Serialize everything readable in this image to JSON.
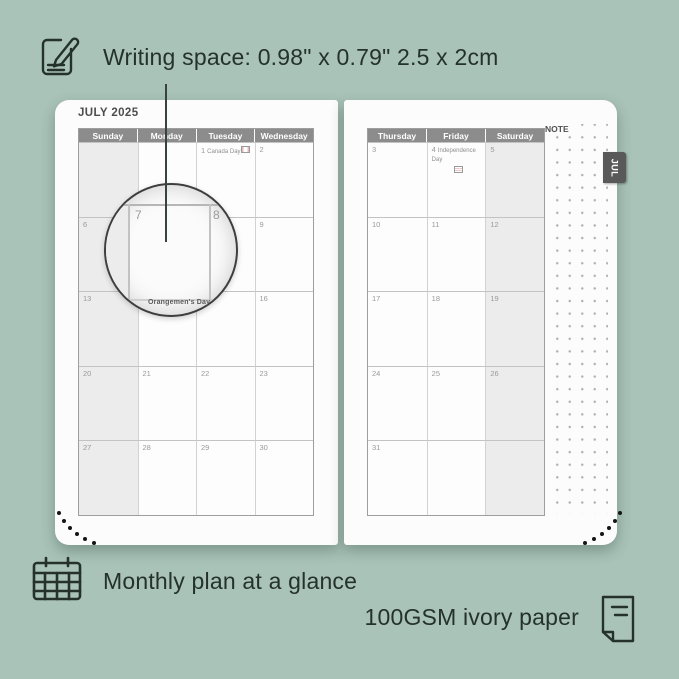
{
  "colors": {
    "background": "#a9c3b8",
    "page": "#fcfcfc",
    "header_bar": "#8c8c8c",
    "weekend_shade": "#ececec",
    "tab": "#595959",
    "ink": "#25322c"
  },
  "annotations": {
    "writing_space": "Writing space: 0.98\" x 0.79\" 2.5 x 2cm",
    "monthly_plan": "Monthly plan at a glance",
    "paper": "100GSM ivory paper"
  },
  "planner": {
    "month_title": "JULY 2025",
    "tab_label": "JUL",
    "note_label": "NOTE",
    "left_page": {
      "headers": [
        "Sunday",
        "Monday",
        "Tuesday",
        "Wednesday"
      ],
      "shaded_header": "Sunday",
      "rows": [
        [
          {
            "d": ""
          },
          {
            "d": ""
          },
          {
            "d": "1",
            "h": "Canada Day",
            "f": "CA"
          },
          {
            "d": "2"
          }
        ],
        [
          {
            "d": "6"
          },
          {
            "d": "7"
          },
          {
            "d": "8"
          },
          {
            "d": "9"
          }
        ],
        [
          {
            "d": "13"
          },
          {
            "d": "14",
            "h": "Orangemen's Day"
          },
          {
            "d": "15"
          },
          {
            "d": "16"
          }
        ],
        [
          {
            "d": "20"
          },
          {
            "d": "21"
          },
          {
            "d": "22"
          },
          {
            "d": "23"
          }
        ],
        [
          {
            "d": "27"
          },
          {
            "d": "28"
          },
          {
            "d": "29"
          },
          {
            "d": "30"
          }
        ]
      ]
    },
    "right_page": {
      "headers": [
        "Thursday",
        "Friday",
        "Saturday"
      ],
      "shaded_header": "Saturday",
      "rows": [
        [
          {
            "d": "3"
          },
          {
            "d": "4",
            "h": "Independence Day",
            "f": "US",
            "fb": true
          },
          {
            "d": "5"
          }
        ],
        [
          {
            "d": "10"
          },
          {
            "d": "11"
          },
          {
            "d": "12"
          }
        ],
        [
          {
            "d": "17"
          },
          {
            "d": "18"
          },
          {
            "d": "19"
          }
        ],
        [
          {
            "d": "24"
          },
          {
            "d": "25"
          },
          {
            "d": "26"
          }
        ],
        [
          {
            "d": "31"
          },
          {
            "d": ""
          },
          {
            "d": ""
          }
        ]
      ]
    },
    "magnifier": {
      "left_day": "7",
      "right_day": "8"
    }
  }
}
